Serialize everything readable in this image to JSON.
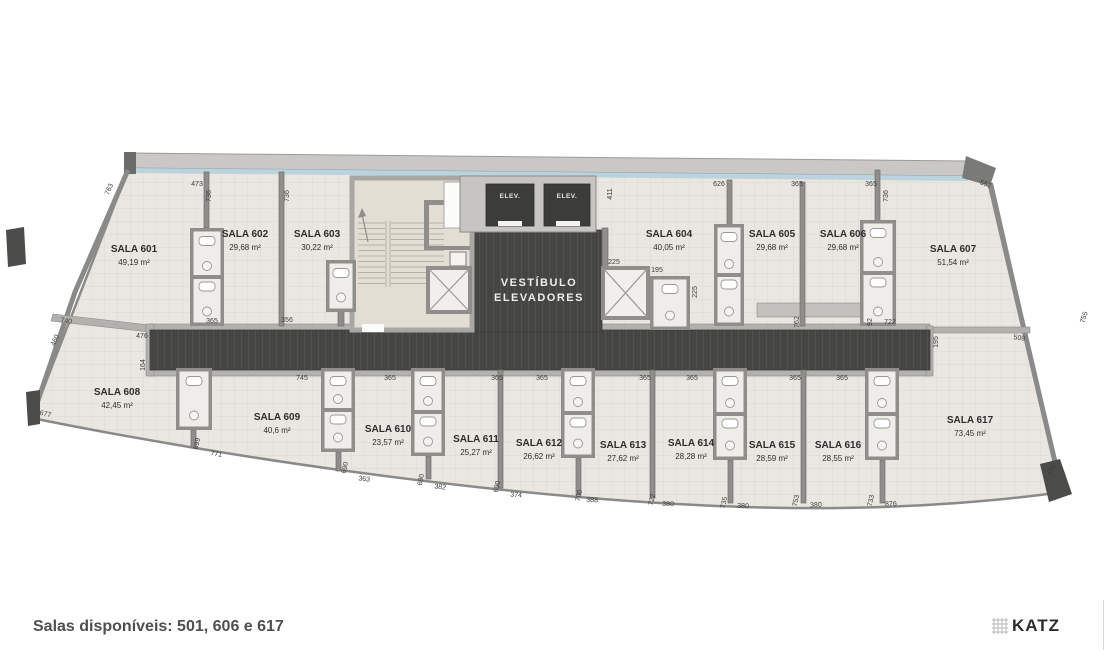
{
  "footer": {
    "note": "Salas disponíveis: 501, 606 e 617",
    "brand": "KATZ"
  },
  "labels": {
    "vestibule_line1": "VESTÍBULO",
    "vestibule_line2": "ELEVADORES",
    "elevator": "ELEV."
  },
  "palette": {
    "floor": "#eae7e2",
    "grid": "#dcd9d3",
    "wall": "#8f8e8b",
    "wall_light": "#b2b1ae",
    "dark": "#454543",
    "elevator": "#3c3c3a",
    "glass": "#b9d3df",
    "slab": "#c9c8c6",
    "stair_floor": "#e3ded3",
    "text": "#2e2e2e",
    "dim_text": "#3c3c3c"
  },
  "rooms": [
    {
      "id": "601",
      "label": "SALA 601",
      "area": "49,19 m²",
      "lx": 134,
      "ly": 252
    },
    {
      "id": "602",
      "label": "SALA 602",
      "area": "29,68 m²",
      "lx": 245,
      "ly": 237
    },
    {
      "id": "603",
      "label": "SALA 603",
      "area": "30,22 m²",
      "lx": 317,
      "ly": 237
    },
    {
      "id": "604",
      "label": "SALA 604",
      "area": "40,05 m²",
      "lx": 669,
      "ly": 237
    },
    {
      "id": "605",
      "label": "SALA 605",
      "area": "29,68 m²",
      "lx": 772,
      "ly": 237
    },
    {
      "id": "606",
      "label": "SALA 606",
      "area": "29,68 m²",
      "lx": 843,
      "ly": 237
    },
    {
      "id": "607",
      "label": "SALA 607",
      "area": "51,54 m²",
      "lx": 953,
      "ly": 252
    },
    {
      "id": "608",
      "label": "SALA 608",
      "area": "42,45 m²",
      "lx": 117,
      "ly": 395
    },
    {
      "id": "609",
      "label": "SALA 609",
      "area": "40,6 m²",
      "lx": 277,
      "ly": 420
    },
    {
      "id": "610",
      "label": "SALA 610",
      "area": "23,57 m²",
      "lx": 388,
      "ly": 432
    },
    {
      "id": "611",
      "label": "SALA 611",
      "area": "25,27 m²",
      "lx": 476,
      "ly": 442
    },
    {
      "id": "612",
      "label": "SALA 612",
      "area": "26,62 m²",
      "lx": 539,
      "ly": 446
    },
    {
      "id": "613",
      "label": "SALA 613",
      "area": "27,62 m²",
      "lx": 623,
      "ly": 448
    },
    {
      "id": "614",
      "label": "SALA 614",
      "area": "28,28 m²",
      "lx": 691,
      "ly": 446
    },
    {
      "id": "615",
      "label": "SALA 615",
      "area": "28,59 m²",
      "lx": 772,
      "ly": 448
    },
    {
      "id": "616",
      "label": "SALA 616",
      "area": "28,55 m²",
      "lx": 838,
      "ly": 448
    },
    {
      "id": "617",
      "label": "SALA 617",
      "area": "73,45 m²",
      "lx": 970,
      "ly": 423
    }
  ],
  "dims": [
    {
      "t": "763",
      "x": 111,
      "y": 190,
      "r": -68
    },
    {
      "t": "473",
      "x": 197,
      "y": 186,
      "r": 0
    },
    {
      "t": "736",
      "x": 211,
      "y": 196,
      "r": -90
    },
    {
      "t": "736",
      "x": 289,
      "y": 196,
      "r": -90
    },
    {
      "t": "411",
      "x": 612,
      "y": 194,
      "r": -90
    },
    {
      "t": "626",
      "x": 719,
      "y": 186,
      "r": 0
    },
    {
      "t": "365",
      "x": 797,
      "y": 186,
      "r": 0
    },
    {
      "t": "365",
      "x": 871,
      "y": 186,
      "r": 0
    },
    {
      "t": "736",
      "x": 888,
      "y": 196,
      "r": -90
    },
    {
      "t": "552",
      "x": 985,
      "y": 186,
      "r": 20
    },
    {
      "t": "740",
      "x": 66,
      "y": 323,
      "r": 7
    },
    {
      "t": "460",
      "x": 57,
      "y": 341,
      "r": -68
    },
    {
      "t": "677",
      "x": 45,
      "y": 416,
      "r": 12
    },
    {
      "t": "476",
      "x": 142,
      "y": 338,
      "r": 0
    },
    {
      "t": "164",
      "x": 145,
      "y": 365,
      "r": -90
    },
    {
      "t": "365",
      "x": 212,
      "y": 323,
      "r": 0
    },
    {
      "t": "356",
      "x": 287,
      "y": 322,
      "r": 0
    },
    {
      "t": "745",
      "x": 302,
      "y": 380,
      "r": 0
    },
    {
      "t": "365",
      "x": 390,
      "y": 380,
      "r": 0
    },
    {
      "t": "365",
      "x": 497,
      "y": 380,
      "r": 0
    },
    {
      "t": "365",
      "x": 542,
      "y": 380,
      "r": 0
    },
    {
      "t": "365",
      "x": 645,
      "y": 380,
      "r": 0
    },
    {
      "t": "365",
      "x": 692,
      "y": 380,
      "r": 0
    },
    {
      "t": "365",
      "x": 795,
      "y": 380,
      "r": 0
    },
    {
      "t": "365",
      "x": 842,
      "y": 380,
      "r": 0
    },
    {
      "t": "225",
      "x": 614,
      "y": 264,
      "r": 0
    },
    {
      "t": "195",
      "x": 657,
      "y": 272,
      "r": 0
    },
    {
      "t": "225",
      "x": 697,
      "y": 292,
      "r": -90
    },
    {
      "t": "762",
      "x": 799,
      "y": 322,
      "r": -90
    },
    {
      "t": "92",
      "x": 872,
      "y": 322,
      "r": -90
    },
    {
      "t": "722",
      "x": 890,
      "y": 324,
      "r": 0
    },
    {
      "t": "195",
      "x": 938,
      "y": 342,
      "r": -90
    },
    {
      "t": "509",
      "x": 1019,
      "y": 340,
      "r": 8
    },
    {
      "t": "755",
      "x": 1086,
      "y": 318,
      "r": -72
    },
    {
      "t": "699",
      "x": 199,
      "y": 444,
      "r": -78
    },
    {
      "t": "771",
      "x": 216,
      "y": 456,
      "r": 8
    },
    {
      "t": "690",
      "x": 347,
      "y": 468,
      "r": -78
    },
    {
      "t": "363",
      "x": 364,
      "y": 481,
      "r": 6
    },
    {
      "t": "690",
      "x": 423,
      "y": 480,
      "r": -78
    },
    {
      "t": "382",
      "x": 440,
      "y": 489,
      "r": 6
    },
    {
      "t": "690",
      "x": 499,
      "y": 487,
      "r": -78
    },
    {
      "t": "374",
      "x": 516,
      "y": 497,
      "r": 5
    },
    {
      "t": "700",
      "x": 581,
      "y": 496,
      "r": -78
    },
    {
      "t": "388",
      "x": 592,
      "y": 502,
      "r": 4
    },
    {
      "t": "722",
      "x": 654,
      "y": 500,
      "r": -78
    },
    {
      "t": "380",
      "x": 668,
      "y": 506,
      "r": 3
    },
    {
      "t": "735",
      "x": 726,
      "y": 503,
      "r": -78
    },
    {
      "t": "380",
      "x": 743,
      "y": 508,
      "r": 2
    },
    {
      "t": "753",
      "x": 798,
      "y": 501,
      "r": -78
    },
    {
      "t": "380",
      "x": 816,
      "y": 507,
      "r": -2
    },
    {
      "t": "733",
      "x": 873,
      "y": 501,
      "r": -78
    },
    {
      "t": "876",
      "x": 891,
      "y": 506,
      "r": -3
    },
    {
      "t": "778",
      "x": 1054,
      "y": 471,
      "r": -70
    }
  ]
}
